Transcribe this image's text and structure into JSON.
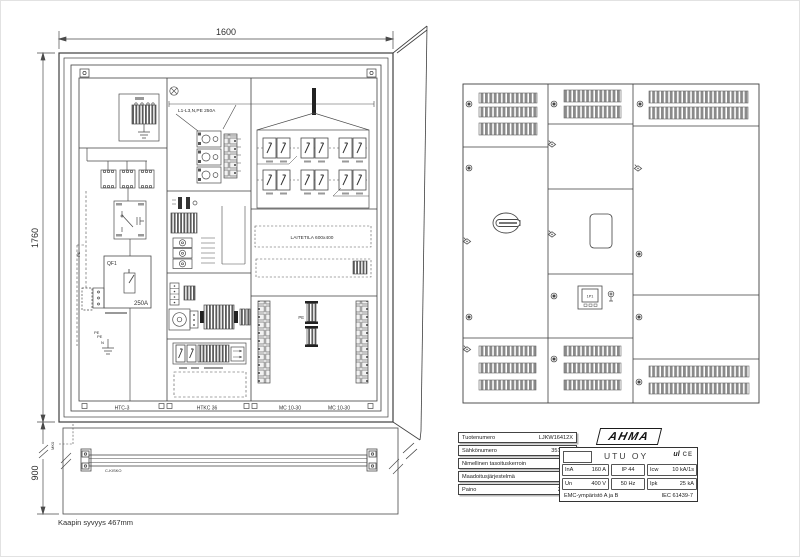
{
  "drawing": {
    "dims": {
      "width": "1600",
      "height": "1760",
      "plinth": "900"
    },
    "depth_note": "Kaapin  syvyys  467mm",
    "bus_label": "L1-L3,N,PE 250A",
    "qf1_label": "QF1",
    "qf1_rating": "250A",
    "laitetila_label": "LAITETILA    600x400",
    "pe_label": "PE",
    "n_label": "N",
    "c_rail_label": "C-KISKO",
    "mk_label": "MK0",
    "bottom_labels": [
      "HTC-3",
      "HTKC 36",
      "MC 10-30",
      "MC 10-30"
    ],
    "meter_label": "1P1"
  },
  "nameplate": {
    "rows": [
      {
        "label": "Tuotenumero",
        "value": "LJKW16412X"
      },
      {
        "label": "Sähkönumero",
        "value": "3510788"
      },
      {
        "label": "Nimellinen tasoituskerroin",
        "value": "1"
      },
      {
        "label": "Maadoitusjärjestelmä",
        "value": "TN-S"
      },
      {
        "label": "Paino",
        "value": "280kg"
      }
    ]
  },
  "ratingplate": {
    "brand": "AHMA",
    "manufacturer": "UTU OY",
    "mark_ul": "ul",
    "mark_ce": "CE",
    "ina_label": "InA",
    "ina_value": "160 A",
    "ip": "IP 44",
    "icw_label": "Icw",
    "icw_value": "10 kA/1s",
    "un_label": "Un",
    "un_value": "400 V",
    "hz": "50 Hz",
    "ipk_label": "Ipk",
    "ipk_value": "25 kA",
    "emc": "EMC-ympäristö  A ja B",
    "iec": "IEC 61439-7"
  }
}
